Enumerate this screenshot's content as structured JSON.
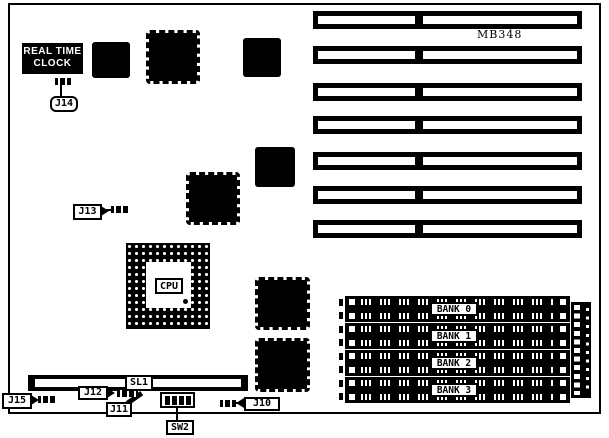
{
  "board": {
    "model": "MB348",
    "rtc": {
      "line1": "REAL TIME",
      "line2": "CLOCK"
    },
    "cpu_label": "CPU",
    "slot_label": "SL1",
    "memory_banks": [
      "BANK 0",
      "BANK 1",
      "BANK 2",
      "BANK 3"
    ],
    "jumpers": {
      "j14": "J14",
      "j13": "J13",
      "j15": "J15",
      "j12": "J12",
      "j11": "J11",
      "j10": "J10",
      "sw2": "SW2"
    }
  }
}
